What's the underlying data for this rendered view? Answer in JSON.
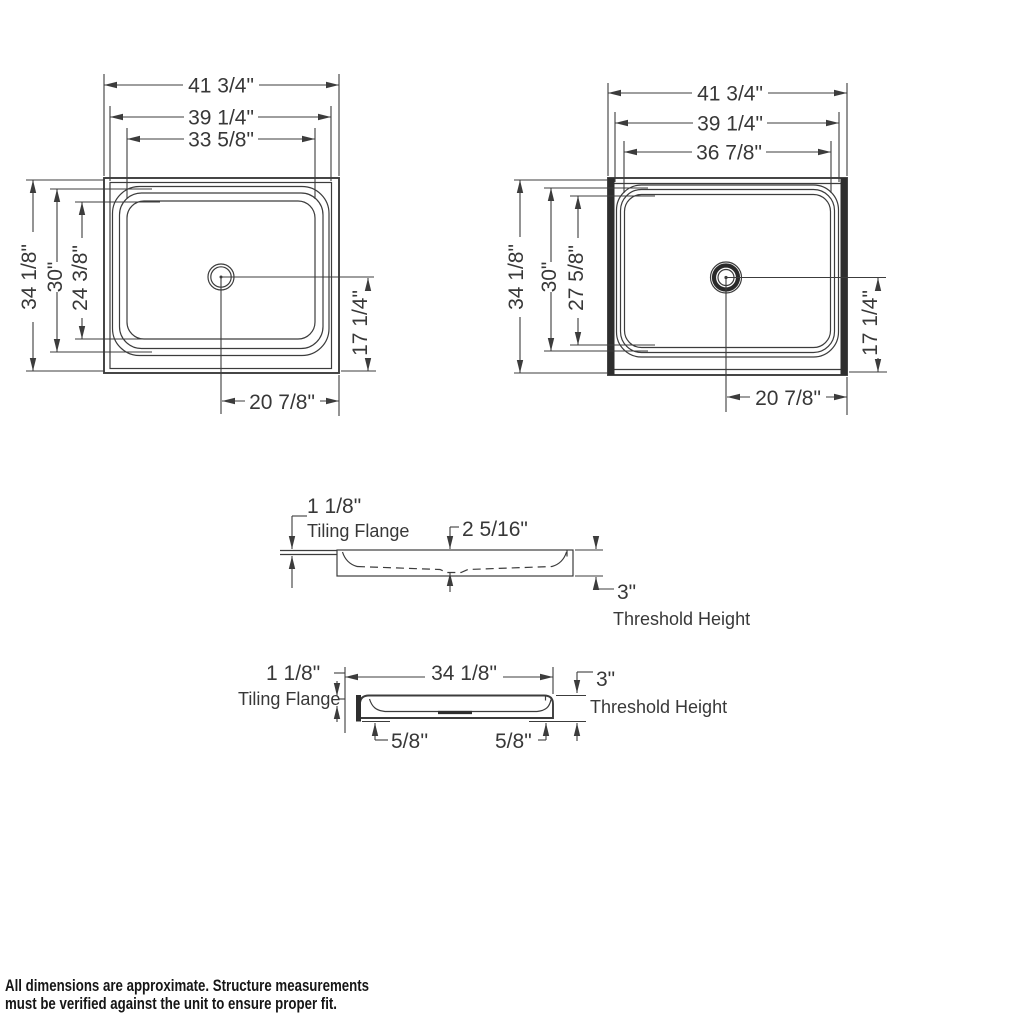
{
  "colors": {
    "ink": "#3c3c3c",
    "text": "#383838",
    "footnote": "#161616",
    "background": "#ffffff"
  },
  "views": {
    "top_left": {
      "width_dims": [
        "41 3/4\"",
        "39 1/4\"",
        "33 5/8\""
      ],
      "height_dims": [
        "34 1/8\"",
        "30\"",
        "24 3/8\""
      ],
      "drain_offset_right": "17 1/4\"",
      "drain_offset_bottom": "20 7/8\""
    },
    "top_right": {
      "width_dims": [
        "41 3/4\"",
        "39 1/4\"",
        "36 7/8\""
      ],
      "height_dims": [
        "34 1/8\"",
        "30\"",
        "27 5/8\""
      ],
      "drain_offset_right": "17 1/4\"",
      "drain_offset_bottom": "20 7/8\""
    },
    "front_section": {
      "flange_height": "1 1/8\"",
      "flange_label": "Tiling Flange",
      "basin_depth": "2 5/16\"",
      "threshold_height": "3\"",
      "threshold_label": "Threshold Height"
    },
    "side_section": {
      "flange_height": "1 1/8\"",
      "flange_label": "Tiling Flange",
      "overall_depth": "34 1/8\"",
      "threshold_height": "3\"",
      "threshold_label": "Threshold Height",
      "floor_inset_left": "5/8''",
      "floor_inset_right": "5/8\""
    }
  },
  "footnote": {
    "line1": "All dimensions are approximate. Structure measurements",
    "line2": "must be verified against the unit to ensure proper fit."
  }
}
